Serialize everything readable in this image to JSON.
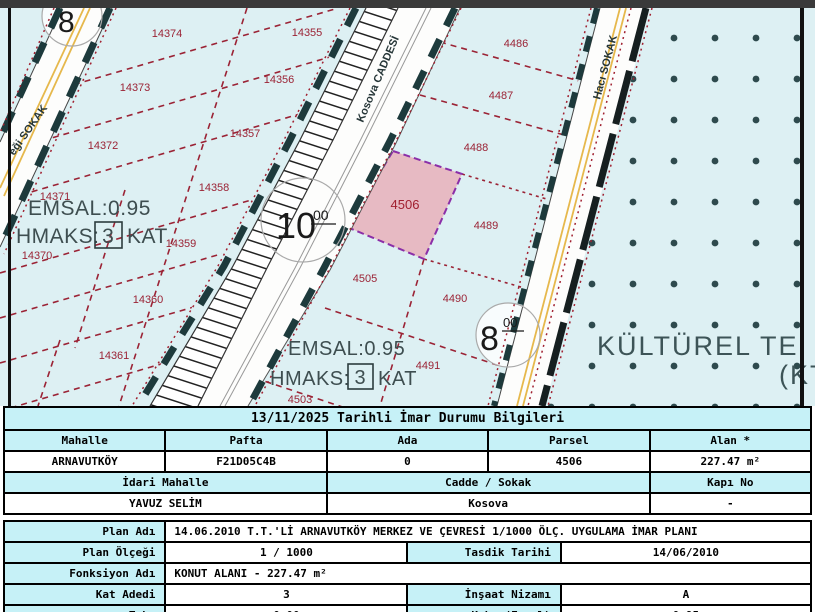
{
  "map": {
    "street_labels": {
      "left": "eği SOKAK",
      "kosova": "Kosova CADDESİ",
      "haci": "Hacı SOKAK"
    },
    "parcel_labels_left": [
      "14374",
      "14355",
      "14373",
      "14356",
      "14372",
      "14357",
      "14358",
      "14370",
      "14371",
      "14359",
      "14360",
      "14361"
    ],
    "parcel_labels_right": [
      "4486",
      "4487",
      "4488",
      "4489",
      "4505",
      "4490",
      "4491",
      "4503"
    ],
    "selected_parcel": "4506",
    "zone_note": {
      "emsal": "EMSAL:0.95",
      "hmaks": "HMAKS:",
      "floors": "3",
      "kat": "KAT"
    },
    "kt_zone": {
      "line1": "KÜLTÜREL TE",
      "line2": "(KT"
    },
    "road_width_circles": {
      "top_left": {
        "num": "8"
      },
      "kosova": {
        "num": "10",
        "sup": "00"
      },
      "haci": {
        "num": "8",
        "sup": "00"
      }
    },
    "colors": {
      "map_bg": "#ddf0f3",
      "selected_fill": "#e7bac3",
      "selected_border": "#8b2fa8",
      "parcel_line": "#9b2335",
      "setback_line": "#1d3a3c",
      "road_yellow": "#e6b84c",
      "header_bg": "#c6f1f7"
    }
  },
  "info_table": {
    "title": "13/11/2025 Tarihli İmar Durumu Bilgileri",
    "headers_row1": [
      "Mahalle",
      "Pafta",
      "Ada",
      "Parsel",
      "Alan *"
    ],
    "values_row1": [
      "ARNAVUTKÖY",
      "F21D05C4B",
      "0",
      "4506",
      "227.47 m²"
    ],
    "headers_row2": [
      "İdari Mahalle",
      "Cadde / Sokak",
      "Kapı No"
    ],
    "values_row2": [
      "YAVUZ SELİM",
      "Kosova",
      "-"
    ]
  },
  "plan_table": {
    "plan_adi_label": "Plan Adı",
    "plan_adi_value": "14.06.2010 T.T.'Lİ ARNAVUTKÖY MERKEZ VE ÇEVRESİ 1/1000 ÖLÇ. UYGULAMA İMAR PLANI",
    "plan_olcegi_label": "Plan Ölçeği",
    "plan_olcegi_value": "1 / 1000",
    "tasdik_label": "Tasdik Tarihi",
    "tasdik_value": "14/06/2010",
    "fonksiyon_label": "Fonksiyon Adı",
    "fonksiyon_value": "KONUT ALANI  - 227.47 m²",
    "kat_adedi_label": "Kat Adedi",
    "kat_adedi_value": "3",
    "insaat_label": "İnşaat Nizamı",
    "insaat_value": "A",
    "taks_label": "Taks",
    "taks_value": "0.00",
    "kaks_label": "Kaks (Emsal)",
    "kaks_value": "0.95"
  }
}
